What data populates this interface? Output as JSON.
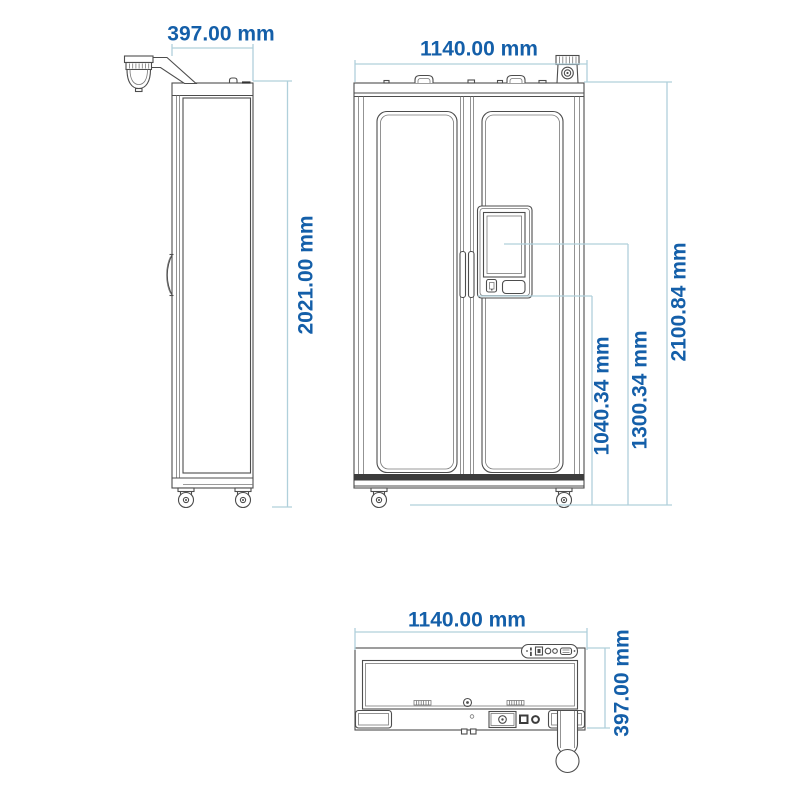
{
  "drawing": {
    "type": "technical-dimension-drawing",
    "views": [
      "side-view",
      "front-view",
      "top-view"
    ]
  },
  "labels": {
    "side_depth": "397.00 mm",
    "side_height": "2021.00 mm",
    "front_width": "1140.00 mm",
    "front_total_height": "2100.84 mm",
    "screen_center_height": "1300.34 mm",
    "panel_bottom_height": "1040.34 mm",
    "top_width": "1140.00 mm",
    "top_depth": "397.00 mm"
  },
  "icons": {
    "camera-icon": "ribbed security camera on cabinet top",
    "dispenser-dome-icon": "dome head on overhead arm",
    "caster-wheel-icon": "swivel caster wheel",
    "lifting-eye-icon": "lifting handle on cabinet roof",
    "kiosk-screen-icon": "touchscreen panel on right door",
    "card-reader-icon": "card reader below screen",
    "top-connector-panel-icon": "connector strip with indicator icons"
  },
  "colors": {
    "page_bg": "#ffffff",
    "dimension_text": "#145fa9",
    "dimension_line": "#b0d0db",
    "drawing_line": "#4d4d4d",
    "dark_band": "#3c3c3c"
  }
}
